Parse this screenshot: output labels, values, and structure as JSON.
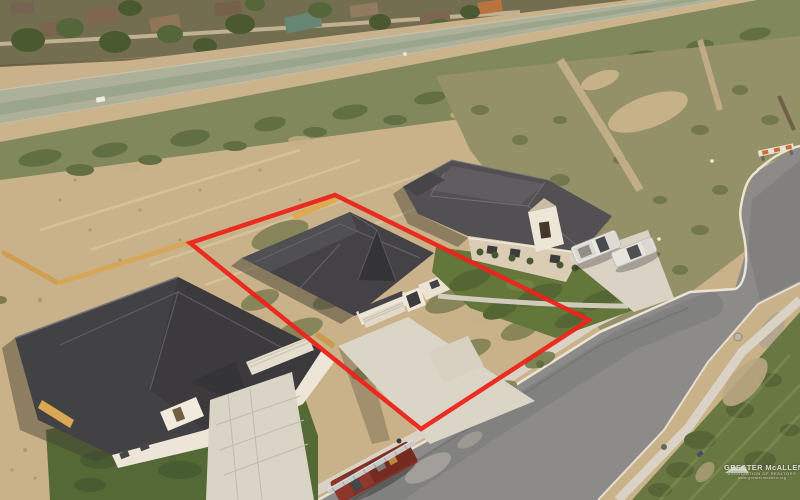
{
  "meta": {
    "type": "aerial-drone-real-estate-photo",
    "description": "Oblique aerial photo of a new-construction subdivision: three homes with dark charcoal roofs, a red outlined property lot around the center home, bare dirt easement and drainage canal behind, curving concrete street in front, vacant scrub lots across the street."
  },
  "watermark": {
    "logo": "roofline-swoosh-icon",
    "org_name": "GREATER McALLEN",
    "tagline": "ASSOCIATION OF REALTORS",
    "website": "www.greatermcallen.org"
  },
  "property_outline": {
    "color": "#EB1C17",
    "points": "190,243 335,195 589,320 421,429"
  },
  "scene": {
    "palette": {
      "dirt": "#C7B28C",
      "canal_concrete": "#A9B29D",
      "shrub_band": "#7A865C",
      "scrub_field": "#8F9069",
      "asphalt": "#868A8C",
      "concrete": "#D9D6CC",
      "roof_dark": "#3A3D45",
      "wall_white": "#ECE8DE",
      "wall_tan": "#D9CEBA",
      "lawn_green": "#4C6635",
      "fence_wood": "#D6A65A",
      "truck_red": "#7D2A22",
      "truck_white": "#E9EAE8"
    },
    "elements": [
      "existing neighborhood with trees along top",
      "concrete drainage canal running diagonally",
      "bare dirt easement with tire tracks",
      "left house under construction with paver driveway",
      "center house inside red lot outline with wide concrete driveway",
      "finished house behind with green lawn and two white pickup trucks",
      "dark red utility truck with silver ladder rack parked on street",
      "yellow wood privacy fence sections",
      "street curving north with construction barricade at dead end"
    ]
  }
}
